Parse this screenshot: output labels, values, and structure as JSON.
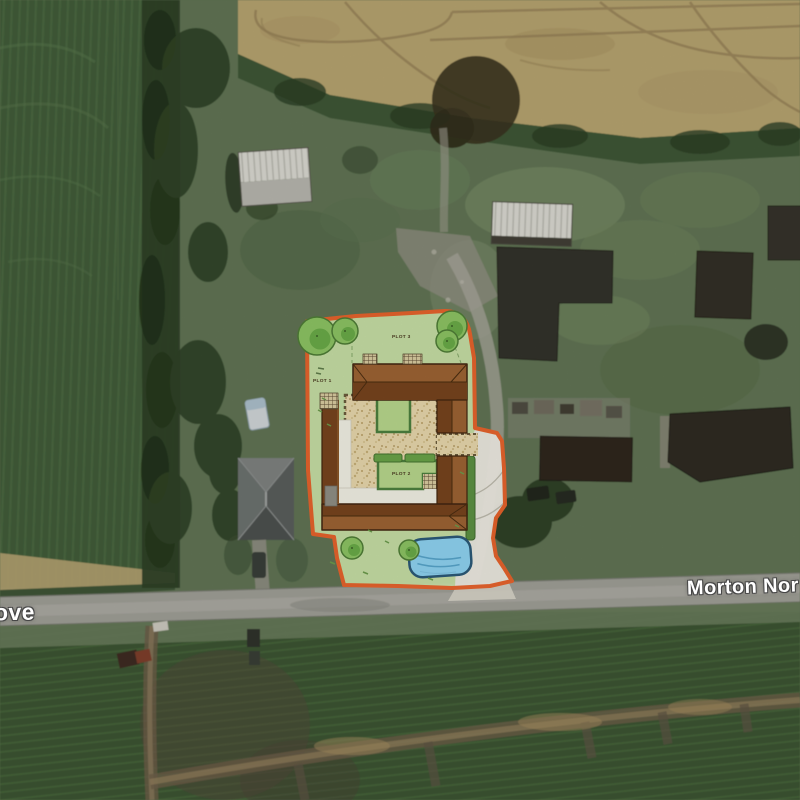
{
  "map": {
    "view": "satellite-aerial-with-development-site-plan-overlay",
    "road_labels": {
      "left_truncated": "ove",
      "right_truncated": "Morton Nor"
    },
    "site_plan": {
      "plots": [
        {
          "label": "PLOT 3"
        },
        {
          "label": "PLOT 1"
        },
        {
          "label": "PLOT 2"
        }
      ],
      "colors": {
        "boundary": "#e8622a",
        "lawn": "#cbe2a9",
        "roof_light": "#9c6232",
        "roof_dark": "#76431d",
        "gravel": "#e9d8ac",
        "pond": "#8ed2f2",
        "pond_outline": "#2a5878",
        "tree": "#8cc464",
        "hedge": "#4c7f3c",
        "driveway": "#ece9e0"
      },
      "features": [
        "site-boundary",
        "courtyard-building",
        "gravel-courtyard",
        "garden-plots",
        "hedges",
        "pond",
        "driveway-entrance",
        "proposed-trees"
      ]
    },
    "terrain": {
      "crop_field_left": "#3f5a37",
      "stubble_field_top": "#b3a06d",
      "scrub_green": "#5f7252",
      "road_gray": "#9c9c94",
      "barn_dark": "#33312a"
    }
  }
}
